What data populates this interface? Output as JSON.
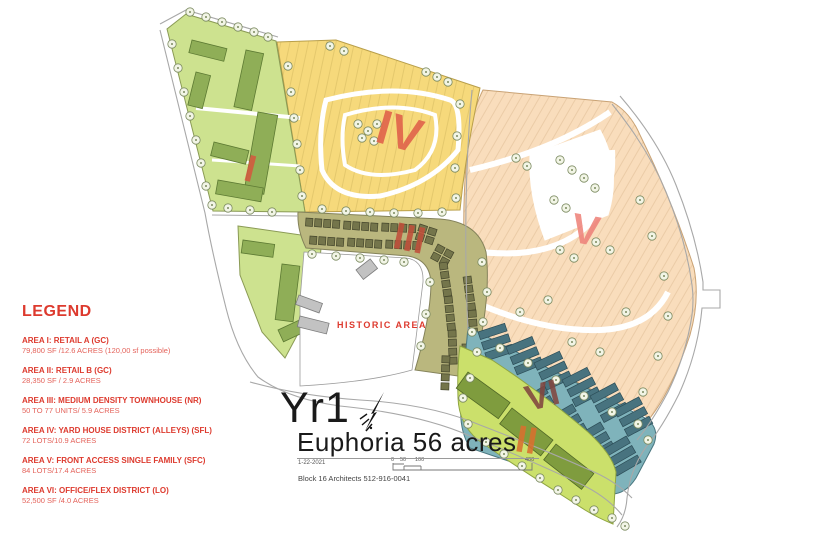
{
  "colors": {
    "area1_fill": "#cde28f",
    "area1_stroke": "#8a9a55",
    "building_green": "#8fae57",
    "building_green_stroke": "#5d7a33",
    "area4_fill": "#f6d97b",
    "area4_stroke": "#b99f4a",
    "area5_fill": "#f9ddbc",
    "area5_stroke": "#c9a274",
    "area3_fill": "#bab77e",
    "area3_stroke": "#84825a",
    "building_olive": "#74754b",
    "building_olive_stroke": "#45462c",
    "area6_fill": "#7fb3bb",
    "area6_stroke": "#49767f",
    "building_teal": "#48737f",
    "building_teal_stroke": "#2c4d57",
    "area2_fill": "#cbe06b",
    "area2_stroke": "#8fa542",
    "building_green2": "#7f9c3e",
    "building_green2_stroke": "#4f6626",
    "historic_stroke": "#9b9b9b",
    "building_gray": "#c2c2c2",
    "building_gray_stroke": "#7d7d7d",
    "road": "#a8a8a8",
    "tree_fill": "#f2f5e6",
    "tree_stroke": "#7b8a60",
    "legend_red": "#dd3a2e",
    "legend_red_light": "#e4625a",
    "numeral_1": "#d4593f",
    "numeral_2": "#d9702f",
    "numeral_3": "#c04f3a",
    "numeral_4": "#e0604a",
    "numeral_5": "#ee837b",
    "numeral_6": "#82463f"
  },
  "legend": {
    "title": "LEGEND",
    "items": [
      {
        "name": "AREA I:  RETAIL A (GC)",
        "detail": "79,800 SF /12.6 ACRES  (120,00 sf possible)"
      },
      {
        "name": "AREA II: RETAIL B (GC)",
        "detail": "28,350 SF / 2.9 ACRES"
      },
      {
        "name": "AREA III: MEDIUM DENSITY TOWNHOUSE (NR)",
        "detail": "50 TO 77 UNITS/ 5.9 ACRES"
      },
      {
        "name": "AREA IV: YARD HOUSE DISTRICT (ALLEYS) (SFL)",
        "detail": "72 LOTS/10.9 ACRES"
      },
      {
        "name": "AREA V: FRONT ACCESS SINGLE FAMILY (SFC)",
        "detail": "84 LOTS/17.4 ACRES"
      },
      {
        "name": "AREA VI:  OFFICE/FLEX DISTRICT (LO)",
        "detail": "52,500 SF /4.0 ACRES"
      }
    ]
  },
  "map": {
    "historic_label": "HISTORIC AREA",
    "numerals": {
      "area1": "I",
      "area2": "II",
      "area3": "III",
      "area4": "IV",
      "area5": "V",
      "area6": "VI"
    }
  },
  "title_block": {
    "phase": "Yr1",
    "project": "Euphoria 56 acres",
    "date": "1-22-2021",
    "firm": "Block 16 Architects 512-916-0041",
    "scale_ticks": [
      "0",
      "50",
      "100",
      "400"
    ]
  }
}
